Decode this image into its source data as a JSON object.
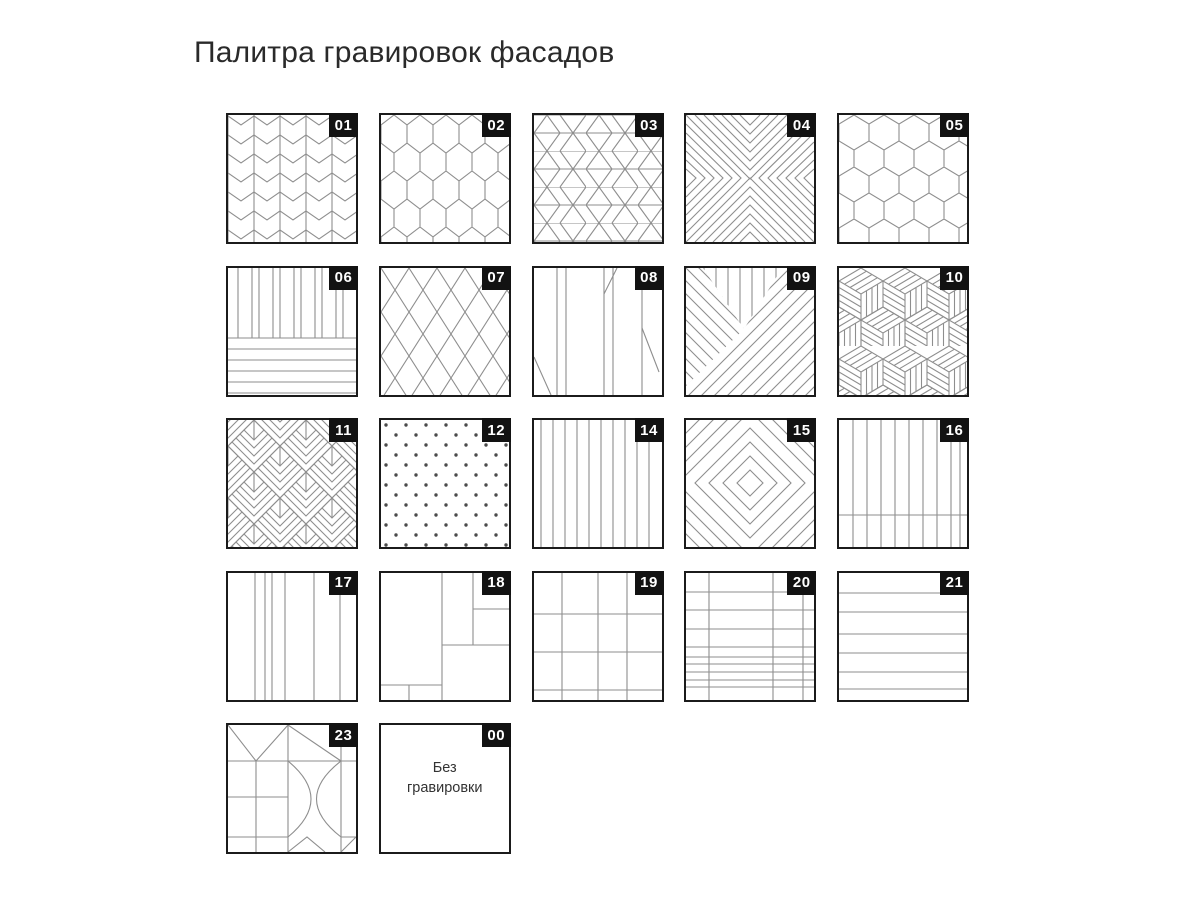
{
  "page": {
    "title": "Палитра гравировок фасадов"
  },
  "colors": {
    "tile_border": "#1b1b1b",
    "pattern_line": "#8e8e8e",
    "badge_bg": "#121212",
    "badge_text": "#ffffff",
    "title_color": "#2a2a2a",
    "label_color": "#333333",
    "dot_color": "#4a4a4a"
  },
  "tiles": [
    {
      "num": "01",
      "pattern": "herringbone-chevron-columns"
    },
    {
      "num": "02",
      "pattern": "elongated-hexagons"
    },
    {
      "num": "03",
      "pattern": "diamond-columns-with-horizontal-lines"
    },
    {
      "num": "04",
      "pattern": "concentric-x-chevrons"
    },
    {
      "num": "05",
      "pattern": "honeycomb-hexagons"
    },
    {
      "num": "06",
      "pattern": "vertical-lines-top-horizontal-lines-bottom"
    },
    {
      "num": "07",
      "pattern": "diagonal-diamond-lattice"
    },
    {
      "num": "08",
      "pattern": "sparse-verticals-with-diagonals"
    },
    {
      "num": "09",
      "pattern": "three-direction-line-fields"
    },
    {
      "num": "10",
      "pattern": "plank-cubes-parquet"
    },
    {
      "num": "11",
      "pattern": "deco-chevron-diamonds"
    },
    {
      "num": "12",
      "pattern": "polka-dots"
    },
    {
      "num": "14",
      "pattern": "vertical-lines"
    },
    {
      "num": "15",
      "pattern": "concentric-diamonds"
    },
    {
      "num": "16",
      "pattern": "vertical-lines-with-bottom-rail"
    },
    {
      "num": "17",
      "pattern": "irregular-vertical-panels"
    },
    {
      "num": "18",
      "pattern": "asymmetric-rectangles"
    },
    {
      "num": "19",
      "pattern": "rectangular-grid"
    },
    {
      "num": "20",
      "pattern": "dense-table-grid"
    },
    {
      "num": "21",
      "pattern": "horizontal-lines"
    },
    {
      "num": "23",
      "pattern": "geometric-collage-with-arcs"
    },
    {
      "num": "00",
      "pattern": "none",
      "label": "Без гравировки"
    }
  ]
}
